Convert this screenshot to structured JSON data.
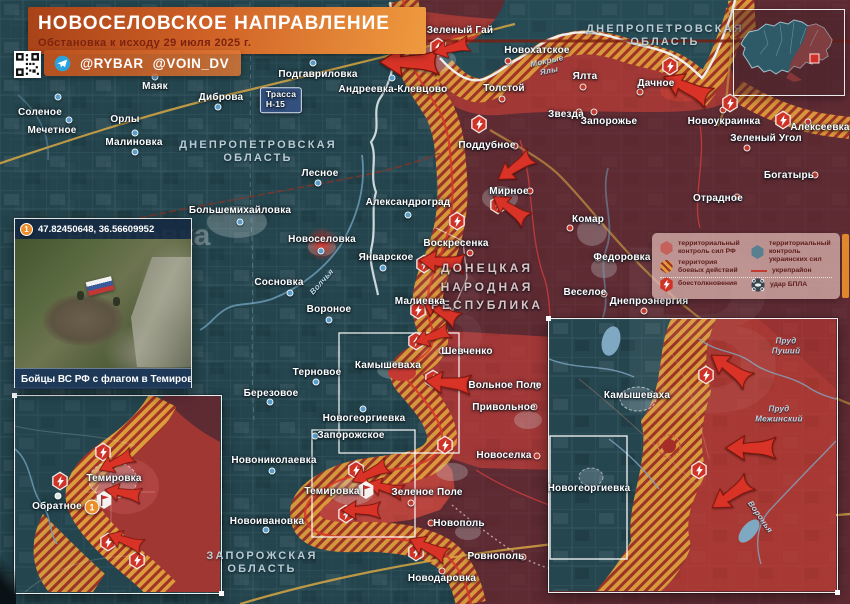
{
  "banner": {
    "title": "НОВОСЕЛОВСКОЕ НАПРАВЛЕНИЕ",
    "subtitle": "Обстановка к исходу 29 июля 2025 г."
  },
  "credits": {
    "handle1": "@RYBAR",
    "handle2": "@VOIN_DV"
  },
  "photo_inset": {
    "marker": "1",
    "coords": "47.82450648, 36.56609952",
    "caption": "Бойцы ВС РФ с флагом в Темировке"
  },
  "legend": {
    "items": [
      {
        "icon": "rf-control-swatch",
        "label": "территориальный контроль сил РФ"
      },
      {
        "icon": "combat-zone-swatch",
        "label": "территория боевых действий"
      },
      {
        "icon": "ua-control-swatch",
        "label": "территориальный контроль украинских сил"
      },
      {
        "icon": "fortified-line-swatch",
        "label": "укрепрайон"
      },
      {
        "icon": "clash-icon",
        "label": "боестолкновения"
      },
      {
        "icon": "uav-strike-icon",
        "label": "удар БПЛА"
      }
    ]
  },
  "colors": {
    "rf_control": "#5f2b33",
    "rf_advance": "#a83833",
    "ua_control": "#24454e",
    "combat_zone": "#dc9c3b",
    "combat_stripe": "#a03226",
    "road": "#d9a844",
    "river": "#6fa0bd",
    "accent_orange": "#e0862c",
    "banner_orange": "#cf6126"
  },
  "map_labels": [
    {
      "t": "ДНЕПРОПЕТРОВСКАЯ\nОБЛАСТЬ",
      "x": 665,
      "y": 36,
      "c": "region",
      "n": "region-label"
    },
    {
      "t": "ДНЕПРОПЕТРОВСКАЯ\nОБЛАСТЬ",
      "x": 258,
      "y": 152,
      "c": "region",
      "n": "region-label"
    },
    {
      "t": "ЗАПОРОЖСКАЯ\nОБЛАСТЬ",
      "x": 262,
      "y": 563,
      "c": "region",
      "n": "region-label"
    },
    {
      "t": "ДОНЕЦКАЯ\nНАРОДНАЯ\nРЕСПУБЛИКА",
      "x": 487,
      "y": 287,
      "c": "dnr",
      "n": "region-label"
    },
    {
      "t": "Соленое",
      "x": 40,
      "y": 113,
      "c": "town"
    },
    {
      "t": "Мечетное",
      "x": 52,
      "y": 131,
      "c": "town"
    },
    {
      "t": "Орлы",
      "x": 125,
      "y": 120,
      "c": "town"
    },
    {
      "t": "Малиновка",
      "x": 134,
      "y": 143,
      "c": "town"
    },
    {
      "t": "Маяк",
      "x": 155,
      "y": 87,
      "c": "town"
    },
    {
      "t": "Диброва",
      "x": 221,
      "y": 98,
      "c": "town"
    },
    {
      "t": "Подгавриловка",
      "x": 318,
      "y": 75,
      "c": "town"
    },
    {
      "t": "Андреевка-Клевцово",
      "x": 393,
      "y": 90,
      "c": "town"
    },
    {
      "t": "Зеленый Гай",
      "x": 460,
      "y": 31,
      "c": "town"
    },
    {
      "t": "Новохатское",
      "x": 537,
      "y": 51,
      "c": "town"
    },
    {
      "t": "Толстой",
      "x": 504,
      "y": 89,
      "c": "town"
    },
    {
      "t": "Ялта",
      "x": 585,
      "y": 77,
      "c": "town"
    },
    {
      "t": "Дачное",
      "x": 656,
      "y": 84,
      "c": "town"
    },
    {
      "t": "Звезда",
      "x": 566,
      "y": 115,
      "c": "town"
    },
    {
      "t": "Запорожье",
      "x": 609,
      "y": 122,
      "c": "town"
    },
    {
      "t": "Новоукраинка",
      "x": 724,
      "y": 122,
      "c": "town"
    },
    {
      "t": "Зеленый Угол",
      "x": 766,
      "y": 139,
      "c": "town"
    },
    {
      "t": "Алексеевка",
      "x": 820,
      "y": 128,
      "c": "town"
    },
    {
      "t": "Богатырь",
      "x": 789,
      "y": 176,
      "c": "town"
    },
    {
      "t": "Отрадное",
      "x": 718,
      "y": 199,
      "c": "town"
    },
    {
      "t": "Поддубное",
      "x": 487,
      "y": 146,
      "c": "town"
    },
    {
      "t": "Мирное",
      "x": 509,
      "y": 192,
      "c": "town"
    },
    {
      "t": "Комар",
      "x": 588,
      "y": 220,
      "c": "town"
    },
    {
      "t": "Федоровка",
      "x": 622,
      "y": 258,
      "c": "town"
    },
    {
      "t": "Веселое",
      "x": 585,
      "y": 293,
      "c": "town"
    },
    {
      "t": "Днепроэнергия",
      "x": 649,
      "y": 302,
      "c": "town"
    },
    {
      "t": "Лесное",
      "x": 320,
      "y": 174,
      "c": "town"
    },
    {
      "t": "Александроград",
      "x": 408,
      "y": 203,
      "c": "town"
    },
    {
      "t": "Большемихайловка",
      "x": 240,
      "y": 211,
      "c": "town"
    },
    {
      "t": "Новоселовка",
      "x": 322,
      "y": 240,
      "c": "town"
    },
    {
      "t": "Январское",
      "x": 386,
      "y": 258,
      "c": "town"
    },
    {
      "t": "Сосновка",
      "x": 279,
      "y": 283,
      "c": "town"
    },
    {
      "t": "Вороное",
      "x": 329,
      "y": 310,
      "c": "town"
    },
    {
      "t": "Воскресенка",
      "x": 456,
      "y": 244,
      "c": "town"
    },
    {
      "t": "Малиевка",
      "x": 420,
      "y": 302,
      "c": "town"
    },
    {
      "t": "Шевченко",
      "x": 467,
      "y": 352,
      "c": "town"
    },
    {
      "t": "Вольное Поле",
      "x": 505,
      "y": 386,
      "c": "town"
    },
    {
      "t": "Привольное",
      "x": 504,
      "y": 408,
      "c": "town"
    },
    {
      "t": "Новоселка",
      "x": 504,
      "y": 456,
      "c": "town"
    },
    {
      "t": "Камышеваха",
      "x": 388,
      "y": 366,
      "c": "town"
    },
    {
      "t": "Терновое",
      "x": 317,
      "y": 373,
      "c": "town"
    },
    {
      "t": "Березовое",
      "x": 271,
      "y": 394,
      "c": "town"
    },
    {
      "t": "Новогеоргиевка",
      "x": 364,
      "y": 419,
      "c": "town"
    },
    {
      "t": "Запорожское",
      "x": 351,
      "y": 436,
      "c": "town"
    },
    {
      "t": "Новониколаевка",
      "x": 274,
      "y": 461,
      "c": "town"
    },
    {
      "t": "Темировка",
      "x": 332,
      "y": 492,
      "c": "town"
    },
    {
      "t": "Зеленое Поле",
      "x": 427,
      "y": 493,
      "c": "town"
    },
    {
      "t": "Новоивановка",
      "x": 267,
      "y": 522,
      "c": "town"
    },
    {
      "t": "Новополь",
      "x": 459,
      "y": 524,
      "c": "town"
    },
    {
      "t": "Ровнополь",
      "x": 496,
      "y": 557,
      "c": "town"
    },
    {
      "t": "Новодаровка",
      "x": 442,
      "y": 579,
      "c": "town"
    },
    {
      "t": "Темировка",
      "x": 114,
      "y": 479,
      "c": "town",
      "n": "inset-town-label"
    },
    {
      "t": "Обратное",
      "x": 57,
      "y": 507,
      "c": "town",
      "n": "inset-town-label"
    },
    {
      "t": "Камышеваха",
      "x": 637,
      "y": 396,
      "c": "town",
      "n": "inset-town-label"
    },
    {
      "t": "Новогеоргиевка",
      "x": 589,
      "y": 489,
      "c": "town",
      "n": "inset-town-label"
    },
    {
      "t": "Мокрые\nЯлы",
      "x": 548,
      "y": 66,
      "c": "river",
      "rot": -12
    },
    {
      "t": "Волчья",
      "x": 322,
      "y": 282,
      "c": "river",
      "rot": -48
    },
    {
      "t": "Пруд\nПуший",
      "x": 786,
      "y": 346,
      "c": "river"
    },
    {
      "t": "Пруд\nМежинский",
      "x": 779,
      "y": 414,
      "c": "river"
    },
    {
      "t": "Воронья",
      "x": 760,
      "y": 517,
      "c": "river",
      "rot": 55
    },
    {
      "t": "Трасса\nН-15",
      "x": 281,
      "y": 100,
      "c": "sign",
      "n": "road-sign-h15"
    }
  ],
  "markers": [
    {
      "x": 58,
      "y": 97,
      "k": "b"
    },
    {
      "x": 69,
      "y": 120,
      "k": "b"
    },
    {
      "x": 135,
      "y": 133,
      "k": "b"
    },
    {
      "x": 135,
      "y": 152,
      "k": "b"
    },
    {
      "x": 155,
      "y": 77,
      "k": "b"
    },
    {
      "x": 218,
      "y": 107,
      "k": "b"
    },
    {
      "x": 313,
      "y": 63,
      "k": "b"
    },
    {
      "x": 392,
      "y": 78,
      "k": "b"
    },
    {
      "x": 318,
      "y": 183,
      "k": "b"
    },
    {
      "x": 408,
      "y": 215,
      "k": "b"
    },
    {
      "x": 240,
      "y": 222,
      "k": "b"
    },
    {
      "x": 321,
      "y": 251,
      "k": "b"
    },
    {
      "x": 383,
      "y": 268,
      "k": "b"
    },
    {
      "x": 290,
      "y": 293,
      "k": "b"
    },
    {
      "x": 329,
      "y": 320,
      "k": "b"
    },
    {
      "x": 316,
      "y": 382,
      "k": "b"
    },
    {
      "x": 270,
      "y": 402,
      "k": "b"
    },
    {
      "x": 363,
      "y": 409,
      "k": "b"
    },
    {
      "x": 315,
      "y": 436,
      "k": "b"
    },
    {
      "x": 272,
      "y": 471,
      "k": "b"
    },
    {
      "x": 266,
      "y": 530,
      "k": "b"
    },
    {
      "x": 461,
      "y": 43,
      "k": "r"
    },
    {
      "x": 508,
      "y": 61,
      "k": "r"
    },
    {
      "x": 502,
      "y": 99,
      "k": "r"
    },
    {
      "x": 583,
      "y": 87,
      "k": "r"
    },
    {
      "x": 640,
      "y": 92,
      "k": "r"
    },
    {
      "x": 579,
      "y": 112,
      "k": "r"
    },
    {
      "x": 594,
      "y": 112,
      "k": "r"
    },
    {
      "x": 723,
      "y": 110,
      "k": "r"
    },
    {
      "x": 747,
      "y": 148,
      "k": "r"
    },
    {
      "x": 808,
      "y": 122,
      "k": "r"
    },
    {
      "x": 815,
      "y": 175,
      "k": "r"
    },
    {
      "x": 737,
      "y": 197,
      "k": "r"
    },
    {
      "x": 515,
      "y": 146,
      "k": "r"
    },
    {
      "x": 530,
      "y": 191,
      "k": "r"
    },
    {
      "x": 570,
      "y": 228,
      "k": "r"
    },
    {
      "x": 598,
      "y": 258,
      "k": "r"
    },
    {
      "x": 604,
      "y": 294,
      "k": "r"
    },
    {
      "x": 644,
      "y": 311,
      "k": "r"
    },
    {
      "x": 470,
      "y": 253,
      "k": "r"
    },
    {
      "x": 448,
      "y": 310,
      "k": "r"
    },
    {
      "x": 442,
      "y": 351,
      "k": "r"
    },
    {
      "x": 537,
      "y": 386,
      "k": "r"
    },
    {
      "x": 534,
      "y": 407,
      "k": "r"
    },
    {
      "x": 537,
      "y": 456,
      "k": "r"
    },
    {
      "x": 411,
      "y": 503,
      "k": "r"
    },
    {
      "x": 431,
      "y": 523,
      "k": "r"
    },
    {
      "x": 523,
      "y": 557,
      "k": "r"
    },
    {
      "x": 442,
      "y": 571,
      "k": "r"
    },
    {
      "x": 58,
      "y": 496,
      "k": "w"
    }
  ],
  "clash_icons": [
    {
      "x": 438,
      "y": 47
    },
    {
      "x": 670,
      "y": 66
    },
    {
      "x": 730,
      "y": 103
    },
    {
      "x": 783,
      "y": 120
    },
    {
      "x": 479,
      "y": 124
    },
    {
      "x": 498,
      "y": 205
    },
    {
      "x": 457,
      "y": 221
    },
    {
      "x": 424,
      "y": 264
    },
    {
      "x": 418,
      "y": 310
    },
    {
      "x": 416,
      "y": 341
    },
    {
      "x": 433,
      "y": 379
    },
    {
      "x": 445,
      "y": 445
    },
    {
      "x": 356,
      "y": 470
    },
    {
      "x": 346,
      "y": 514
    },
    {
      "x": 416,
      "y": 552
    },
    {
      "x": 103,
      "y": 452
    },
    {
      "x": 60,
      "y": 481
    },
    {
      "x": 108,
      "y": 542
    },
    {
      "x": 137,
      "y": 560
    },
    {
      "x": 706,
      "y": 375
    },
    {
      "x": 699,
      "y": 470
    }
  ],
  "arrows": [
    {
      "x": 411,
      "y": 62,
      "rot": 0,
      "s": 1.3
    },
    {
      "x": 452,
      "y": 48,
      "rot": -15,
      "s": 0.8
    },
    {
      "x": 688,
      "y": 88,
      "rot": 25,
      "s": 1.1
    },
    {
      "x": 516,
      "y": 167,
      "rot": -35,
      "s": 0.9
    },
    {
      "x": 511,
      "y": 209,
      "rot": 35,
      "s": 0.9
    },
    {
      "x": 443,
      "y": 262,
      "rot": 5,
      "s": 1.0
    },
    {
      "x": 441,
      "y": 311,
      "rot": 30,
      "s": 0.9
    },
    {
      "x": 433,
      "y": 336,
      "rot": -20,
      "s": 0.8
    },
    {
      "x": 449,
      "y": 383,
      "rot": 5,
      "s": 1.0
    },
    {
      "x": 371,
      "y": 473,
      "rot": -25,
      "s": 0.85
    },
    {
      "x": 386,
      "y": 488,
      "rot": 15,
      "s": 0.8
    },
    {
      "x": 362,
      "y": 510,
      "rot": 0,
      "s": 0.85
    },
    {
      "x": 429,
      "y": 548,
      "rot": 25,
      "s": 0.9
    },
    {
      "x": 117,
      "y": 462,
      "rot": -25,
      "s": 0.8
    },
    {
      "x": 124,
      "y": 493,
      "rot": 10,
      "s": 0.8
    },
    {
      "x": 126,
      "y": 541,
      "rot": 20,
      "s": 0.8
    },
    {
      "x": 731,
      "y": 369,
      "rot": 35,
      "s": 1.0
    },
    {
      "x": 752,
      "y": 448,
      "rot": 0,
      "s": 1.1
    },
    {
      "x": 732,
      "y": 494,
      "rot": -35,
      "s": 1.0
    }
  ],
  "flags": [
    {
      "x": 366,
      "y": 490
    },
    {
      "x": 104,
      "y": 500
    }
  ],
  "badges": [
    {
      "x": 92,
      "y": 507,
      "n": "1"
    }
  ],
  "watermarks": [
    {
      "t": "Темировка",
      "x": 130,
      "y": 236,
      "size": 30,
      "op": 0.3,
      "n": "photo-watermark"
    },
    {
      "t": "З",
      "x": 447,
      "y": 315,
      "size": 130,
      "op": 0.05,
      "n": "logo-watermark"
    },
    {
      "t": "В",
      "x": 700,
      "y": 330,
      "size": 240,
      "op": 0.05,
      "n": "logo-watermark"
    }
  ]
}
